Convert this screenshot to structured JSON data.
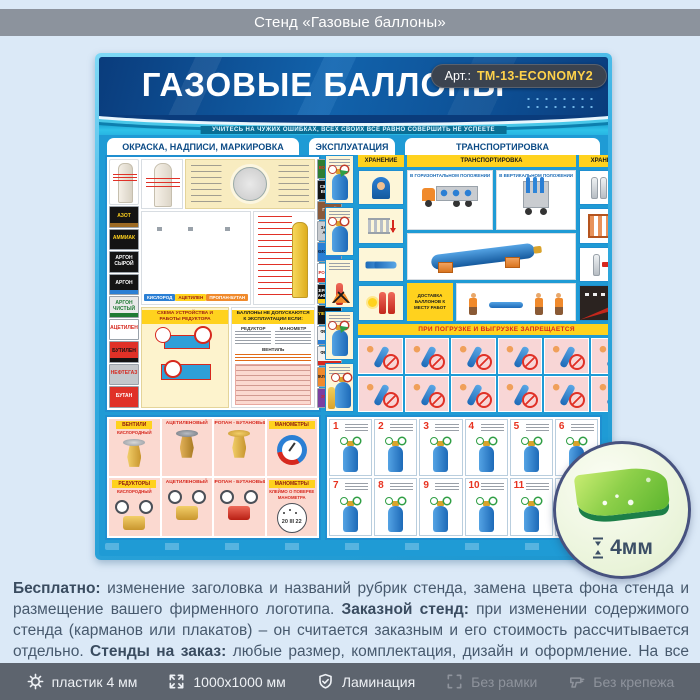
{
  "header": {
    "title": "Стенд «Газовые баллоны»"
  },
  "poster": {
    "title": "ГАЗОВЫЕ БАЛЛОНЫ",
    "art": {
      "label": "Арт.:",
      "value": "ТМ-13-ECONOMY2"
    },
    "motto": "УЧИТЕСЬ НА ЧУЖИХ ОШИБКАХ, ВСЕХ СВОИХ ВСЁ РАВНО СОВЕРШИТЬ НЕ УСПЕЕТЕ",
    "tabs": [
      {
        "label": "ОКРАСКА, НАДПИСИ, МАРКИРОВКА"
      },
      {
        "label": "ЭКСПЛУАТАЦИЯ"
      },
      {
        "label": "ТРАНСПОРТИРОВКА"
      }
    ],
    "gas_labels_left": [
      {
        "t": "АЗОТ",
        "bg": "#141414",
        "fg": "#ffd21e",
        "st": "#9c6a24"
      },
      {
        "t": "АММИАК",
        "bg": "#141414",
        "fg": "#ffd21e",
        "st": "transparent"
      },
      {
        "t": "АРГОН СЫРОЙ",
        "bg": "#141414",
        "fg": "#ffffff",
        "st": "transparent"
      },
      {
        "t": "АРГОН",
        "bg": "#141414",
        "fg": "#ffffff",
        "st": "#2b7fd4"
      },
      {
        "t": "АРГОН ЧИСТЫЙ",
        "bg": "#e9e9e9",
        "fg": "#1f7a33",
        "st": "#1f7a33"
      },
      {
        "t": "АЦЕТИЛЕН",
        "bg": "#ffffff",
        "fg": "#d6281e",
        "st": "transparent"
      },
      {
        "t": "БУТИЛЕН",
        "bg": "#e03127",
        "fg": "#141414",
        "st": "#141414"
      },
      {
        "t": "НЕФТЕГАЗ",
        "bg": "#c3c7cb",
        "fg": "#d6281e",
        "st": "transparent"
      },
      {
        "t": "БУТАН",
        "bg": "#e03127",
        "fg": "#ffffff",
        "st": "transparent"
      }
    ],
    "gas_labels_right": [
      {
        "t": "ВОДОРОД",
        "bg": "#2e7d32",
        "fg": "#e03127",
        "st": "transparent"
      },
      {
        "t": "СЖАТЫЙ ВОЗДУХ",
        "bg": "#141414",
        "fg": "#ffffff",
        "st": "transparent"
      },
      {
        "t": "ГЕЛИЙ",
        "bg": "#8a5a3a",
        "fg": "#ffffff",
        "st": "transparent"
      },
      {
        "t": "ЗАКИСЬ АЗОТА",
        "bg": "#c9ccd0",
        "fg": "#141414",
        "st": "transparent"
      },
      {
        "t": "КИСЛОРОД",
        "bg": "#2b7fd4",
        "fg": "#0b1e3a",
        "st": "transparent"
      },
      {
        "t": "СЕРОВОДОРОД",
        "bg": "#ffffff",
        "fg": "#d6281e",
        "st": "#d6281e"
      },
      {
        "t": "СЕРНИСТЫЙ АНГИДРИД",
        "bg": "#141414",
        "fg": "#ffffff",
        "st": "#ffd21e"
      },
      {
        "t": "УГЛЕКИСЛОТА",
        "bg": "#141414",
        "fg": "#ffd21e",
        "st": "transparent"
      },
      {
        "t": "ФРЕОН - 11",
        "bg": "#f2f2f2",
        "fg": "#141414",
        "st": "#2b7fd4"
      },
      {
        "t": "ФРЕОН - 13",
        "bg": "#f2f2f2",
        "fg": "#141414",
        "st": "#d6281e"
      },
      {
        "t": "ЦИКЛОПРОПАН",
        "bg": "#f08a2c",
        "fg": "#141414",
        "st": "transparent"
      },
      {
        "t": "ЭТИЛЕН",
        "bg": "#7b3fa0",
        "fg": "#d6281e",
        "st": "transparent"
      }
    ],
    "cylinder_captions": [
      {
        "t": "КИСЛОРОД",
        "bg": "#2b7fd4",
        "fg": "#ffffff"
      },
      {
        "t": "АЦЕТИЛЕН",
        "bg": "#ffd21e",
        "fg": "#9b1c12"
      },
      {
        "t": "ПРОПАН-БУТАН",
        "bg": "#f08a2c",
        "fg": "#ffffff"
      }
    ],
    "sectionA": {
      "scheme_title": "СХЕМА УСТРОЙСТВА И РАБОТЫ РЕДУКТОРА",
      "rules_title": "БАЛЛОНЫ НЕ ДОПУСКАЮТСЯ К ЭКСПЛУАТАЦИИ ЕСЛИ:",
      "rules_col1": "РЕДУКТОР",
      "rules_col2": "МАНОМЕТР",
      "rules_col3": "ВЕНТИЛЬ"
    },
    "transport": {
      "bar_left": "ХРАНЕНИЕ",
      "bar_mid": "ТРАНСПОРТИРОВКА",
      "bar_right": "ХРАНЕНИЕ",
      "sub_horizontal": "В ГОРИЗОНТАЛЬНОМ ПОЛОЖЕНИИ",
      "sub_vertical": "В ВЕРТИКАЛЬНОМ ПОЛОЖЕНИИ",
      "delivery": "ДОСТАВКА БАЛЛОНОВ К МЕСТУ РАБОТ",
      "forbidden": "ПРИ ПОГРУЗКЕ И ВЫГРУЗКЕ ЗАПРЕЩАЕТСЯ"
    },
    "equipment": {
      "row1": [
        {
          "head": "ВЕНТИЛИ",
          "sub": "КИСЛОРОДНЫЙ"
        },
        {
          "head": "АЦЕТИЛЕНОВЫЙ",
          "sub": ""
        },
        {
          "head": "ПРОПАН - БУТАНОВЫЙ",
          "sub": ""
        },
        {
          "head": "МАНОМЕТРЫ",
          "sub": ""
        }
      ],
      "row2": [
        {
          "head": "РЕДУКТОРЫ",
          "sub": "КИСЛОРОДНЫЙ"
        },
        {
          "head": "АЦЕТИЛЕНОВЫЙ",
          "sub": ""
        },
        {
          "head": "ПРОПАН - БУТАНОВЫЙ",
          "sub": ""
        },
        {
          "head": "МАНОМЕТРЫ",
          "sub": "КЛЕЙМО О ПОВЕРКЕ МАНОМЕТРА"
        }
      ],
      "stamp": "20 III 22"
    },
    "steps": [
      "1",
      "2",
      "3",
      "4",
      "5",
      "6",
      "7",
      "8",
      "9",
      "10",
      "11",
      "12"
    ]
  },
  "badge": {
    "thickness": "4мм"
  },
  "description": {
    "segments": [
      {
        "text": "Бесплатно:",
        "w": "700"
      },
      {
        "text": " изменение заголовка и названий рубрик стенда, замена цвета фона стенда и размещение вашего фирменного логотипа. ",
        "w": "400"
      },
      {
        "text": "Заказной стенд:",
        "w": "700"
      },
      {
        "text": " при изменении содержимого стенда (карманов или плакатов) – он считается заказным и его стоимость рассчитывается отдельно. ",
        "w": "400"
      },
      {
        "text": "Стенды на заказ:",
        "w": "700"
      },
      {
        "text": " любые размер, комплектация, дизайн и оформление. На все изготовленные стенды даем 2 года гарантии. Выгодно, эстетично и надежно!",
        "w": "400"
      }
    ]
  },
  "footer": {
    "items": [
      {
        "label": "пластик 4 мм",
        "icon": "gear",
        "active": true
      },
      {
        "label": "1000x1000 мм",
        "icon": "expand",
        "active": true
      },
      {
        "label": "Ламинация",
        "icon": "shield-check",
        "active": true
      },
      {
        "label": "Без рамки",
        "icon": "frame",
        "active": false
      },
      {
        "label": "Без крепежа",
        "icon": "drill",
        "active": false
      }
    ]
  }
}
